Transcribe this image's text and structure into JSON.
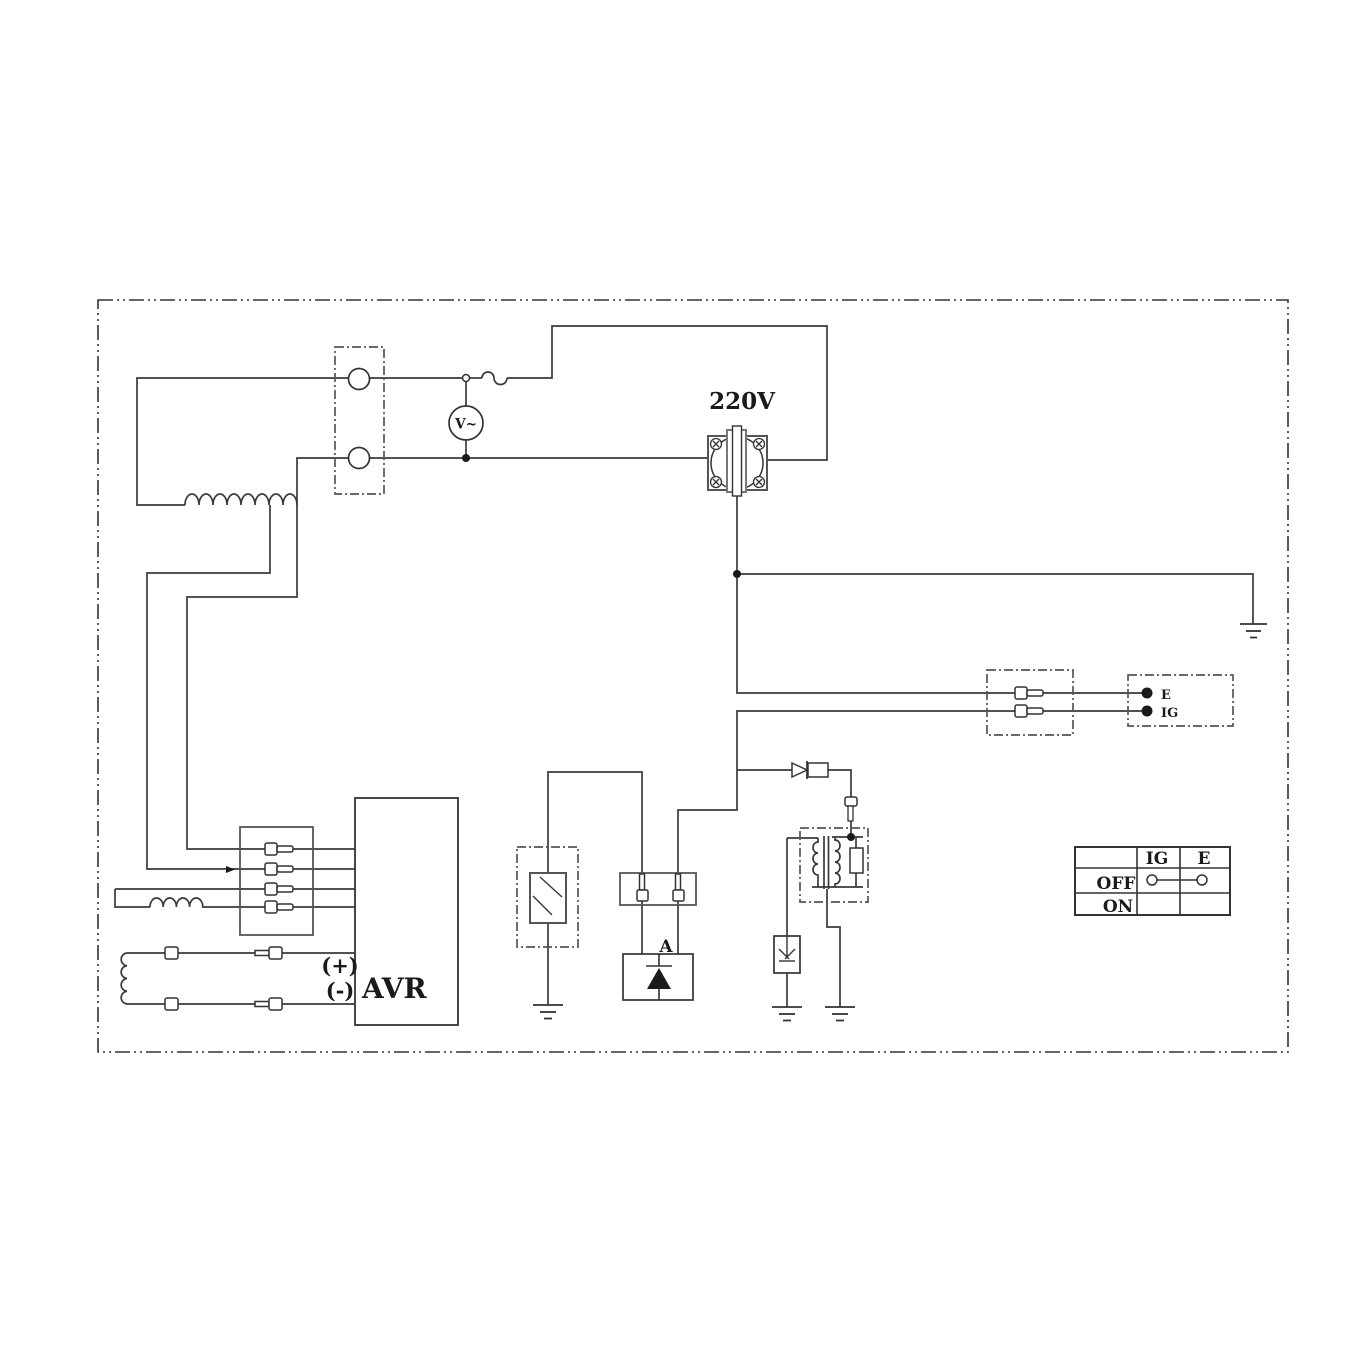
{
  "diagram": {
    "type": "generator-avr-wiring-diagram",
    "labels": {
      "voltage": "220V",
      "voltmeter": "V~",
      "avr": "AVR",
      "field_plus": "(+)",
      "field_minus": "(-)",
      "diode_unit": "A"
    },
    "ignition_terminals": {
      "e": "E",
      "ig": "IG"
    },
    "switch_table": {
      "col_ig": "IG",
      "col_e": "E",
      "row_off": "OFF",
      "row_on": "ON",
      "off_connection": "IG-E"
    },
    "colors": {
      "line": "#333333",
      "background": "#ffffff"
    }
  }
}
